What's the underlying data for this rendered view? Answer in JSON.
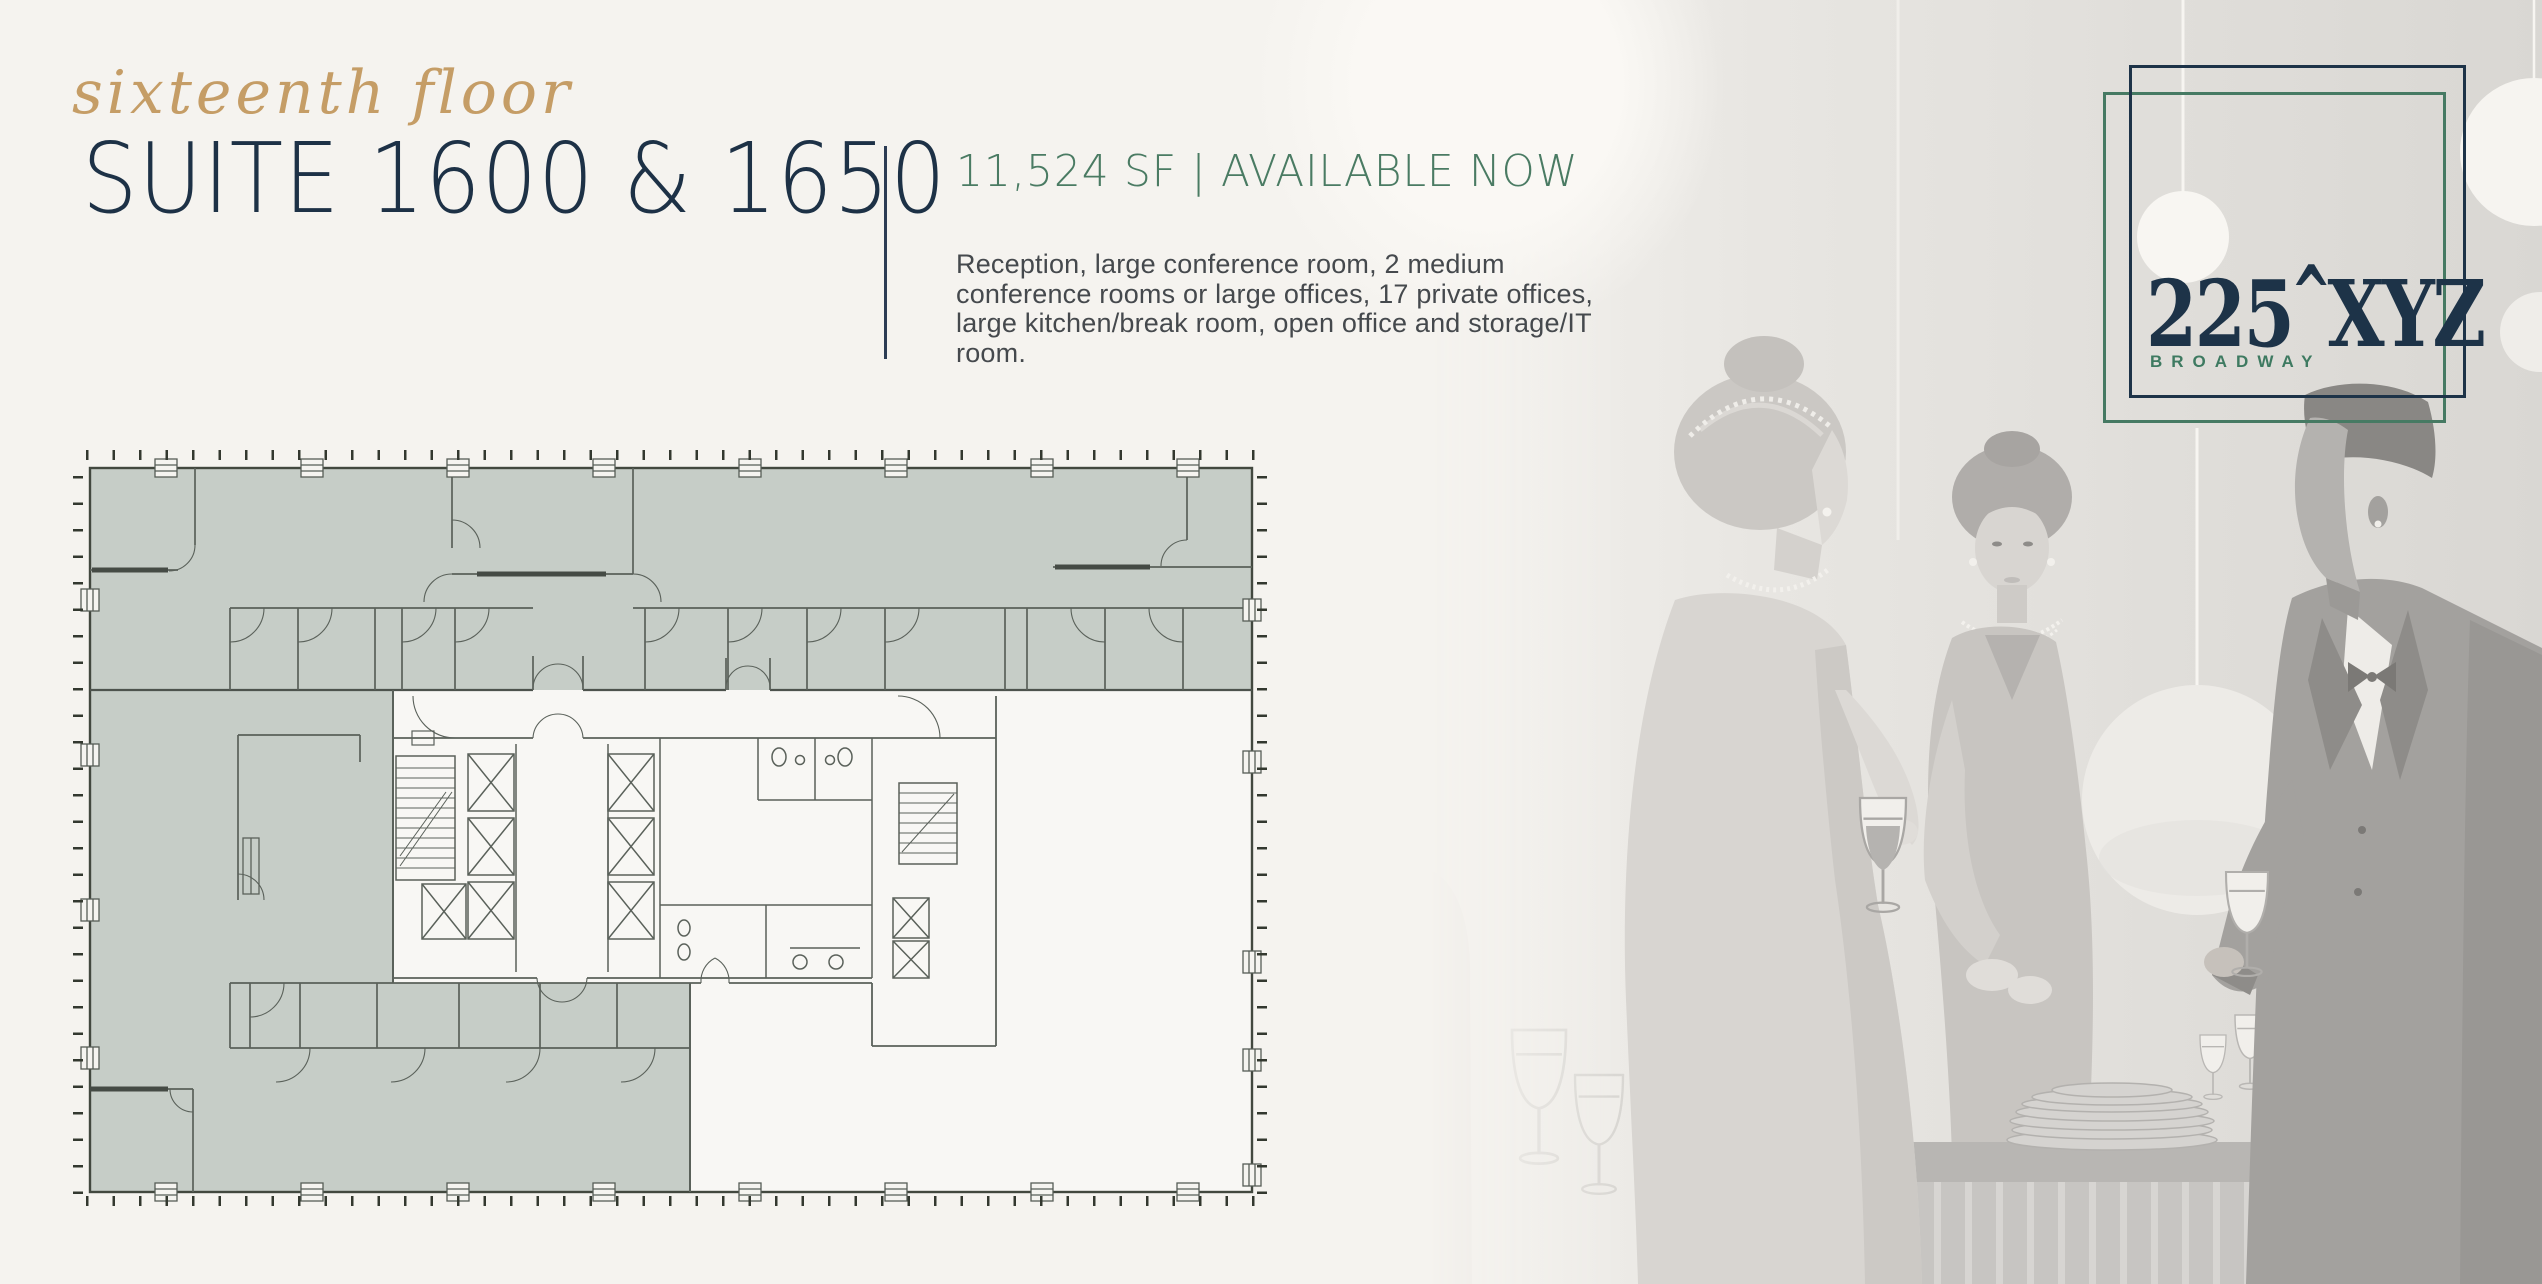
{
  "colors": {
    "background": "#f5f3ef",
    "navy": "#1d3348",
    "gold": "#c59d66",
    "green": "#467a63",
    "body_text": "#45494d",
    "plan_highlight": "#c6cdc7",
    "plan_wall": "#5a615a"
  },
  "header": {
    "eyebrow": "sixteenth floor",
    "title": "SUITE 1600 & 1650"
  },
  "details": {
    "availability": "11,524 SF | AVAILABLE NOW",
    "description": "Reception, large conference room, 2 medium conference rooms or large offices, 17 private offices, large kitchen/break room, open office and storage/IT room."
  },
  "logo": {
    "number": "225",
    "caret": "^",
    "suffix": "XYZ",
    "subtitle": "BROADWAY"
  },
  "floor_plan": {
    "name": "suite-1600-1650-floor-plan",
    "highlight_color": "#c6cdc7"
  },
  "illustration": {
    "name": "cocktail-party-illustration"
  }
}
